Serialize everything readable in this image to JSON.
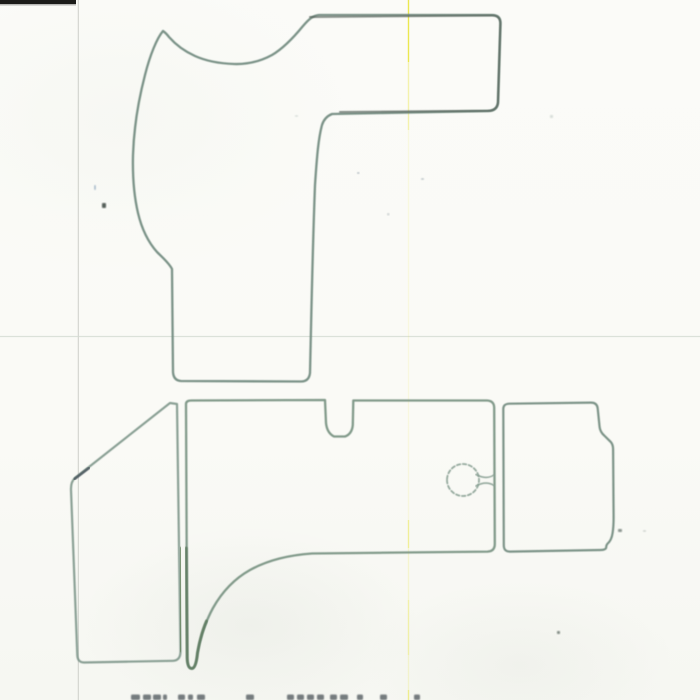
{
  "document": {
    "kind": "scanned pattern/template sheet with hand-traced outlines",
    "visible_text": "",
    "bottom_text_cut_off": true
  },
  "palette": {
    "paper": "#fafaf7",
    "outline_teal": "#6d877c",
    "outline_dark": "#57635c",
    "outline_green": "#5d7a5f",
    "artifact_yellow": "#eae73e",
    "artifact_gray": "#c7c9c3",
    "toner_black": "#1b1b19"
  },
  "shapes": [
    {
      "name": "top-pattern-outline",
      "d": "M163 31 C157 38 150 55 145 75 C139 98 134 125 133 155 C132.5 175 134 196 138 213 C142 230 149 243 157 252 C163 258 169 263 172 269 L173 372 Q173.5 380.5 181 381 L301 381.5 Q309 381.5 310 373 C311 330 312.5 250 315 185 C317 155 318.5 138 322 125 Q324.5 117 332 114 L488 111 Q497 111 498 103 L500.5 23 Q500.5 15 492 15 L319 15 C313 15.5 309 19 303 26 C294 37 284 48 272 55 C261 61 248 64.5 234 64 C220 63.5 206 61 195 56 C185 51.5 176 45 169 37 Q166 33 163 31 Z",
      "stroke": "#6d877c",
      "width": 2.3,
      "opacity": 0.9
    },
    {
      "name": "top-pattern-arm-emphasis",
      "d": "M310 17 L492 15.5 Q500.5 15.5 500.3 24 L498 102 Q497.3 110.5 488 110.8 L340 112",
      "stroke": "#57635c",
      "width": 2.0,
      "opacity": 0.7
    },
    {
      "name": "left-mat-outline",
      "d": "M170 403 L177 404 L180.5 651 Q180.6 660.5 173 660.8 L84 662.5 Q77.5 662.3 77.3 655 L71 490 Q70.7 481.5 75 478 Z",
      "stroke": "#7e968a",
      "width": 2.2,
      "opacity": 0.9
    },
    {
      "name": "left-mat-dark-corner-segment",
      "d": "M89 468 L74.5 479",
      "stroke": "#4e5a60",
      "width": 2.6,
      "opacity": 0.9
    },
    {
      "name": "left-mat-right-edge-dark",
      "d": "M180.4 548 L180.6 651",
      "stroke": "#68855f",
      "width": 2.6,
      "opacity": 0.8
    },
    {
      "name": "center-mat-outline",
      "d": "M186 404 Q186 400.5 191.5 400.5 L325 400 L326 423 Q327 433 334 436.5 L345 436.5 Q352 434 352.8 425 L353.3 400.5 L487 400.5 Q494 400.8 494.2 407.5 L494.8 544 Q494.8 551.3 487.5 551.6 L312 553.5 C290 555 268 560 250 570 C234 579 222 592 213 608 C205.5 621.5 200 639 197.5 653 Q196 668.5 191.8 668.5 Q187.6 668.5 187.2 659 L186 404 Z",
      "stroke": "#75907f",
      "width": 2.3,
      "opacity": 0.9
    },
    {
      "name": "center-mat-heel-dark-segment",
      "d": "M186.2 548 L187.2 658 Q187.6 668.5 191.8 668.5 Q196 668.5 197.5 653 C199.5 641 202.5 630 206.5 621",
      "stroke": "#5d7a5f",
      "width": 2.8,
      "opacity": 0.85
    },
    {
      "name": "drain-hole-circle",
      "d": "M447 480 a16 16 0 1 0 32 0 a16 16 0 1 0 -32 0",
      "stroke": "#8aa194",
      "width": 1.8,
      "dash": "3.5 2.5",
      "opacity": 0.9
    },
    {
      "name": "drain-hole-neck",
      "d": "M476 474.5 Q486 480 494 475 M476 486 Q486 480.5 494 485.5",
      "stroke": "#8aa194",
      "width": 1.6,
      "opacity": 0.9
    },
    {
      "name": "right-mat-outline",
      "d": "M503.3 409 Q503.2 403.8 509.5 403.7 L591 402.6 Q597.2 402.6 597.7 408.5 L599.6 427 Q600.2 432 604.2 435.5 L610.6 441.8 Q613 444.3 613.1 449 L613.6 516 Q613.7 526 612.6 533 Q611.5 540.5 607.4 543.8 Q606 545.5 606.2 547.5 Q606 549.8 600.8 550 L510 551.6 Q503.9 551.7 503.8 545.5 Z",
      "stroke": "#6e887b",
      "width": 2.2,
      "opacity": 0.9
    }
  ],
  "artifacts": {
    "toner_bar": {
      "x": 0,
      "y": 0,
      "w": 76,
      "h": 4,
      "color": "#1b1b19"
    },
    "vertical_gray_line": {
      "x": 78.3,
      "color": "#c7c9c3",
      "opacity": 0.8
    },
    "horizontal_fold_line": {
      "y": 336.5,
      "color": "#d4dbd2",
      "opacity": 0.8
    },
    "vertical_yellow_line": {
      "x": 408.5,
      "color": "#eae73e",
      "segments": [
        [
          0,
          62,
          0.9
        ],
        [
          62,
          130,
          0.4
        ],
        [
          130,
          520,
          0.12
        ],
        [
          520,
          548,
          0.5
        ],
        [
          548,
          600,
          0.2
        ],
        [
          600,
          655,
          0.4
        ],
        [
          655,
          690,
          0.2
        ],
        [
          690,
          700,
          0.55
        ]
      ]
    }
  },
  "specks": [
    {
      "x": 94,
      "y": 185,
      "w": 2,
      "h": 5,
      "color": "#9fb4c6",
      "opacity": 0.8
    },
    {
      "x": 102,
      "y": 203,
      "w": 4,
      "h": 5,
      "color": "#454f4a",
      "opacity": 0.9
    },
    {
      "x": 295,
      "y": 115,
      "w": 3,
      "h": 2,
      "color": "#b8c2bd",
      "opacity": 0.45
    },
    {
      "x": 357,
      "y": 172,
      "w": 2.5,
      "h": 2,
      "color": "#8f9ea8",
      "opacity": 0.6
    },
    {
      "x": 421,
      "y": 178,
      "w": 3,
      "h": 2,
      "color": "#98a6ad",
      "opacity": 0.55
    },
    {
      "x": 387,
      "y": 213,
      "w": 2.5,
      "h": 2.5,
      "color": "#a4b0b4",
      "opacity": 0.5
    },
    {
      "x": 550,
      "y": 115,
      "w": 3,
      "h": 3,
      "color": "#b3bfba",
      "opacity": 0.5
    },
    {
      "x": 618,
      "y": 529,
      "w": 4,
      "h": 3,
      "color": "#6e7d74",
      "opacity": 0.8
    },
    {
      "x": 643,
      "y": 530,
      "w": 3,
      "h": 2,
      "color": "#aab5ae",
      "opacity": 0.5
    },
    {
      "x": 557,
      "y": 631,
      "w": 3,
      "h": 3,
      "color": "#636e67",
      "opacity": 0.8
    }
  ],
  "footer_marks": {
    "y": 694.5,
    "h": 5.5,
    "color": "#4c5358",
    "opacity": 0.75,
    "xs": [
      [
        131,
        9
      ],
      [
        143,
        8
      ],
      [
        153,
        8
      ],
      [
        163,
        4
      ],
      [
        178,
        7
      ],
      [
        188,
        5
      ],
      [
        197,
        8
      ],
      [
        246,
        8
      ],
      [
        287,
        7
      ],
      [
        297,
        7
      ],
      [
        307,
        7
      ],
      [
        317,
        7
      ],
      [
        330,
        7
      ],
      [
        340,
        8
      ],
      [
        357,
        6
      ],
      [
        380,
        7
      ],
      [
        414,
        6
      ]
    ]
  }
}
